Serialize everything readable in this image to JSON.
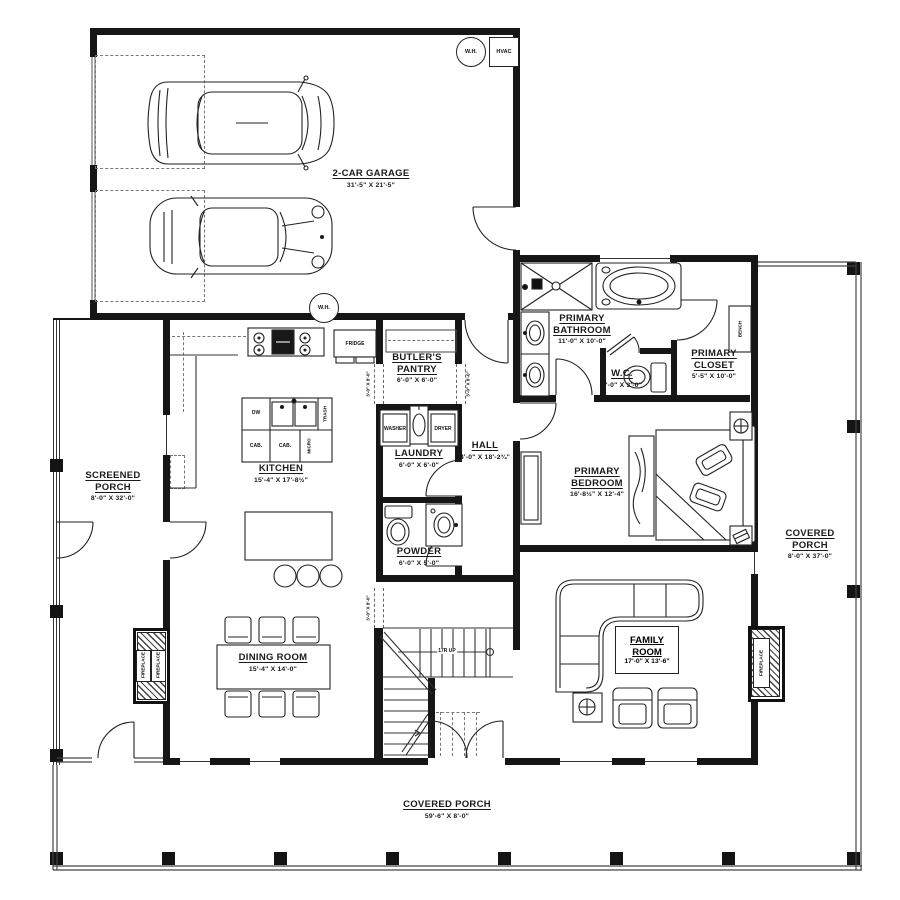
{
  "plan": {
    "garage": {
      "name": "2-CAR GARAGE",
      "dims": "31'-5\" X 21'-5\""
    },
    "screened_porch": {
      "line1": "SCREENED",
      "line2": "PORCH",
      "dims": "8'-0\" X 32'-0\""
    },
    "kitchen": {
      "name": "KITCHEN",
      "dims": "15'-4\" X 17'-8½\""
    },
    "butlers_pantry": {
      "line1": "BUTLER'S",
      "line2": "PANTRY",
      "dims": "6'-0\" X 6'-0\""
    },
    "laundry": {
      "name": "LAUNDRY",
      "dims": "6'-0\" X 6'-0\""
    },
    "hall": {
      "name": "HALL",
      "dims": "4'-0\" X 18'-2¾\""
    },
    "powder": {
      "name": "POWDER",
      "dims": "6'-0\" X 5'-0\""
    },
    "primary_bathroom": {
      "line1": "PRIMARY",
      "line2": "BATHROOM",
      "dims": "11'-0\" X 10'-0\""
    },
    "wc": {
      "name": "W.C.",
      "dims": "5'-0\" X 3'-0\""
    },
    "primary_closet": {
      "line1": "PRIMARY",
      "line2": "CLOSET",
      "dims": "5'-5\" X 10'-0\""
    },
    "primary_bedroom": {
      "line1": "PRIMARY",
      "line2": "BEDROOM",
      "dims": "16'-8½\" X 12'-4\""
    },
    "dining_room": {
      "name": "DINING ROOM",
      "dims": "15'-4\" X 14'-0\""
    },
    "family_room": {
      "line1": "FAMILY",
      "line2": "ROOM",
      "dims": "17'-0\" X 13'-6\""
    },
    "covered_porch_right": {
      "line1": "COVERED",
      "line2": "PORCH",
      "dims": "8'-0\" X 37'-0\""
    },
    "covered_porch_bottom": {
      "name": "COVERED PORCH",
      "dims": "59'-6\" X 8'-0\""
    }
  },
  "labels": {
    "wh": "W.H.",
    "hvac": "HVAC",
    "fridge": "FRIDGE",
    "washer": "WASHER",
    "dryer": "DRYER",
    "dw": "DW",
    "cab": "CAB.",
    "micro": "MICRO",
    "trash": "TRASH",
    "bench": "BENCH",
    "fireplace": "FIREPLACE",
    "stairs": "17R UP",
    "opening": "3'-0\" X 8'-0\""
  }
}
